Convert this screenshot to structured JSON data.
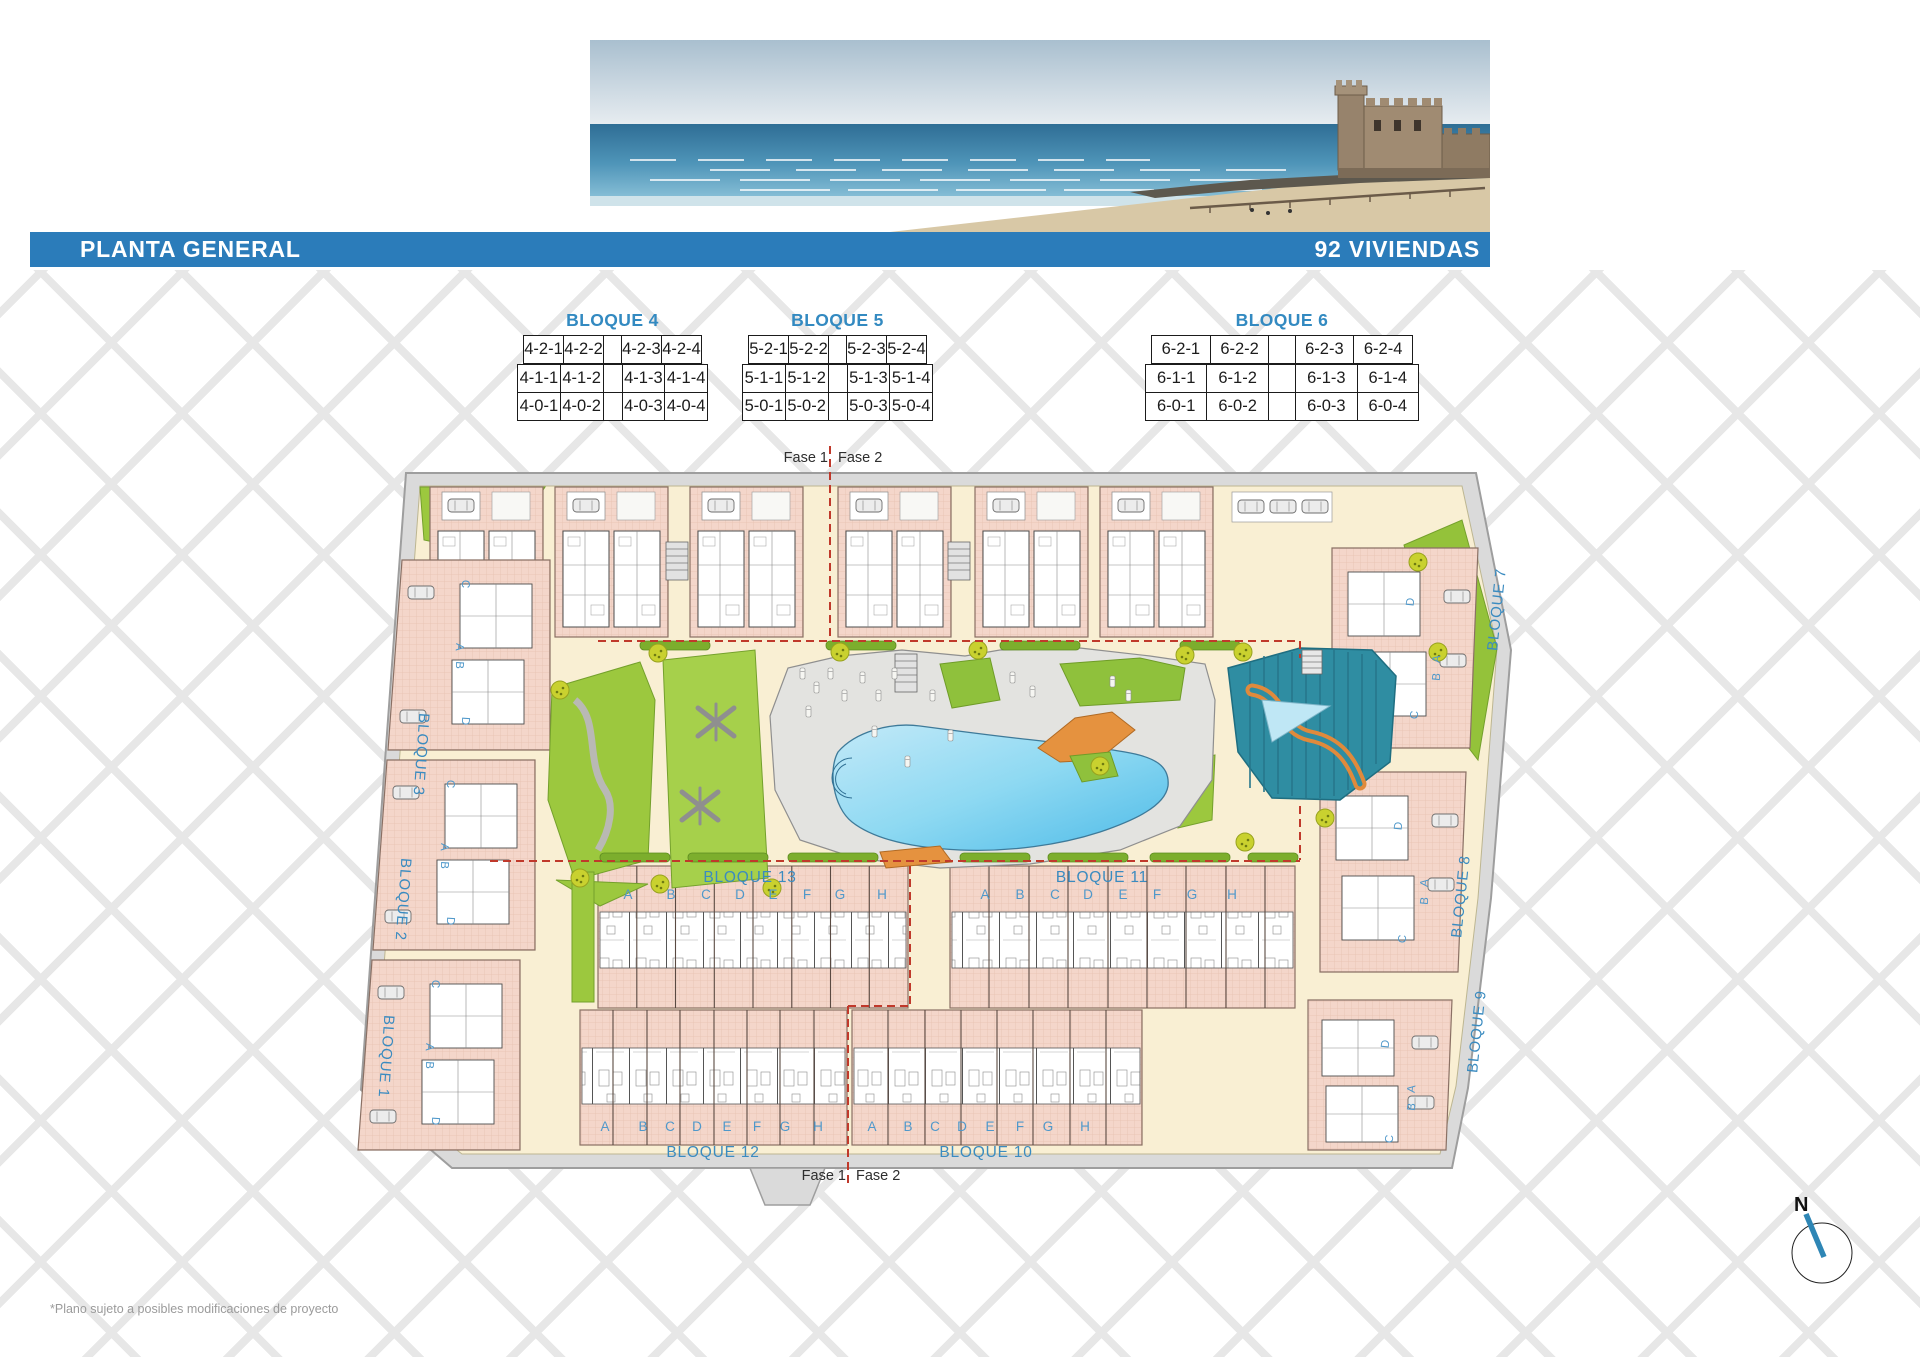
{
  "header": {
    "title": "PLANTA GENERAL",
    "units_label": "92 VIVIENDAS"
  },
  "photo": {
    "description": "beach panorama with watch tower"
  },
  "tables": [
    {
      "title": "BLOQUE 4",
      "rows": [
        [
          "4-2-1",
          "4-2-2",
          "4-2-3",
          "4-2-4"
        ],
        [
          "4-1-1",
          "4-1-2",
          "4-1-3",
          "4-1-4"
        ],
        [
          "4-0-1",
          "4-0-2",
          "4-0-3",
          "4-0-4"
        ]
      ]
    },
    {
      "title": "BLOQUE 5",
      "rows": [
        [
          "5-2-1",
          "5-2-2",
          "5-2-3",
          "5-2-4"
        ],
        [
          "5-1-1",
          "5-1-2",
          "5-1-3",
          "5-1-4"
        ],
        [
          "5-0-1",
          "5-0-2",
          "5-0-3",
          "5-0-4"
        ]
      ]
    },
    {
      "title": "BLOQUE 6",
      "rows": [
        [
          "6-2-1",
          "6-2-2",
          "6-2-3",
          "6-2-4"
        ],
        [
          "6-1-1",
          "6-1-2",
          "6-1-3",
          "6-1-4"
        ],
        [
          "6-0-1",
          "6-0-2",
          "6-0-3",
          "6-0-4"
        ]
      ]
    }
  ],
  "plan": {
    "fase1": "Fase 1",
    "fase2": "Fase 2",
    "row_blocks": [
      {
        "name": "BLOQUE 13",
        "units": [
          "A",
          "B",
          "C",
          "D",
          "E",
          "F",
          "G",
          "H"
        ]
      },
      {
        "name": "BLOQUE 11",
        "units": [
          "A",
          "B",
          "C",
          "D",
          "E",
          "F",
          "G",
          "H"
        ]
      },
      {
        "name": "BLOQUE 12",
        "units": [
          "A",
          "B",
          "C",
          "D",
          "E",
          "F",
          "G",
          "H"
        ]
      },
      {
        "name": "BLOQUE 10",
        "units": [
          "A",
          "B",
          "C",
          "D",
          "E",
          "F",
          "G",
          "H"
        ]
      }
    ],
    "left_blocks": [
      "BLOQUE 3",
      "BLOQUE 2",
      "BLOQUE 1"
    ],
    "right_blocks": [
      "BLOQUE 7",
      "BLOQUE 8",
      "BLOQUE 9"
    ],
    "cluster_letters_left": [
      "C",
      "A",
      "B",
      "D"
    ],
    "cluster_letters_right": [
      "D",
      "A",
      "B",
      "C"
    ],
    "compass": "N"
  },
  "footnote": "*Plano sujeto a posibles modificaciones de proyecto",
  "colors": {
    "title_bar": "#2b7cba",
    "accent_blue": "#338ac1",
    "letter_blue": "#4f98ca",
    "building_pink": "#f4d6ca",
    "pool_blue": "#5fc4ea",
    "grass_green": "#9cc83e",
    "splash_teal": "#2f8da2",
    "path_cream": "#f9efd3",
    "phase_red": "#c0392b"
  }
}
